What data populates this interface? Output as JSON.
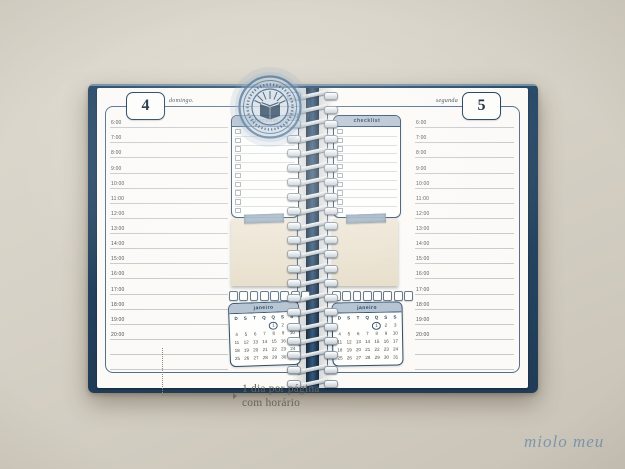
{
  "left_page": {
    "day_number": "4",
    "day_name": "domingo."
  },
  "right_page": {
    "day_number": "5",
    "day_name": "segunda"
  },
  "schedule": {
    "times": [
      "6:00",
      "7:00",
      "8:00",
      "9:00",
      "10:00",
      "11:00",
      "12:00",
      "13:00",
      "14:00",
      "15:00",
      "16:00",
      "17:00",
      "18:00",
      "19:00",
      "20:00",
      "",
      ""
    ]
  },
  "checklist": {
    "title": "checklist",
    "row_count": 10
  },
  "habit_tracker": {
    "box_count": 8
  },
  "calendar": {
    "month": "janeiro",
    "dow": [
      "D",
      "S",
      "T",
      "Q",
      "Q",
      "S",
      "S"
    ],
    "cells": [
      "",
      "",
      "",
      "",
      "1",
      "2",
      "3",
      "4",
      "5",
      "6",
      "7",
      "8",
      "9",
      "10",
      "11",
      "12",
      "13",
      "14",
      "15",
      "16",
      "17",
      "18",
      "19",
      "20",
      "21",
      "22",
      "23",
      "24",
      "25",
      "26",
      "27",
      "28",
      "29",
      "30",
      "31"
    ],
    "highlight_day": "1"
  },
  "spiral": {
    "coil_count": 21
  },
  "annotation": {
    "line1": "1 dia por página",
    "line2": "com horário"
  },
  "brand": {
    "logo_text": "miolo meu"
  },
  "icons": {
    "seal_center": "open-book-stamp"
  },
  "colors": {
    "cover_navy": "#24415d",
    "accent_navy": "#2f4d6a",
    "header_band_blue": "#b3c2d1",
    "sticky_note": "#ebe3d3",
    "background": "#d5d0c5",
    "seal_blue": "#4a7093",
    "logo_blue": "#7d97ac"
  }
}
